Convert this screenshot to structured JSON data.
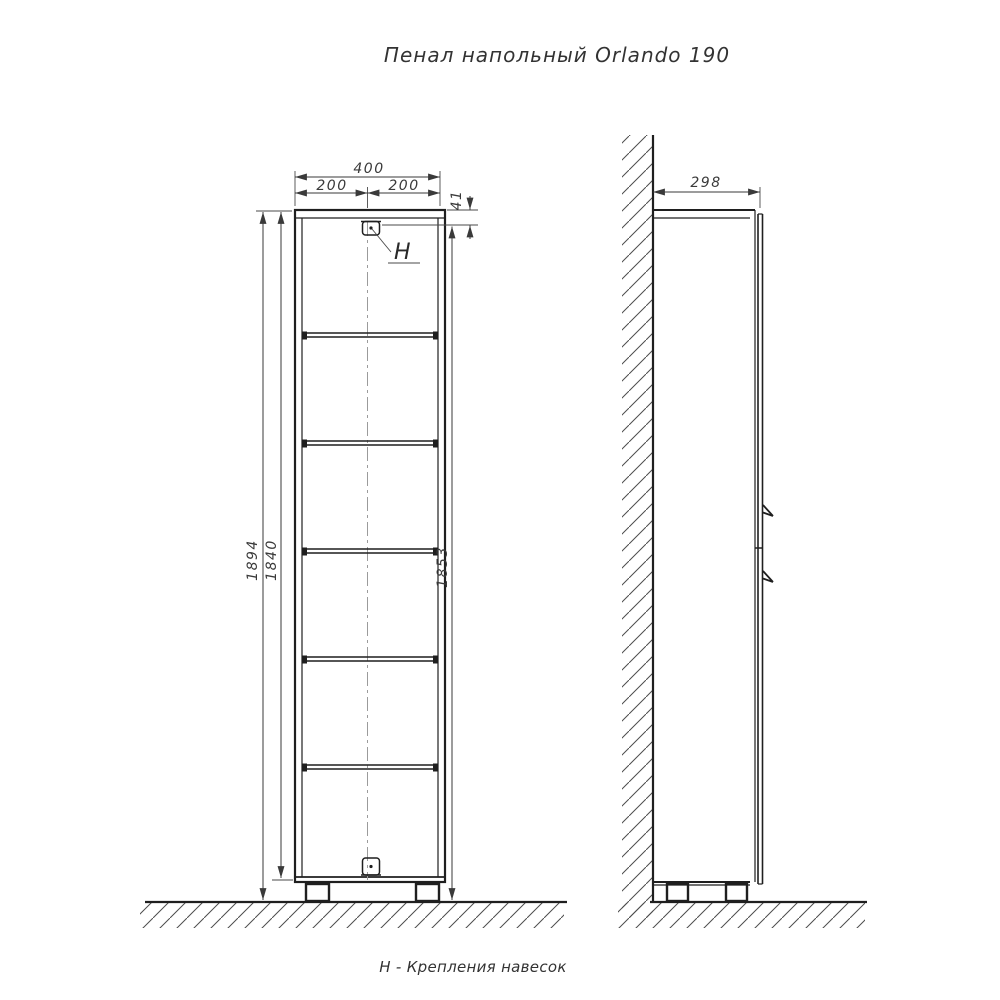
{
  "title": "Пенал напольный Orlando 190",
  "footnote": "Н - Крепления навесок",
  "hanger_marker": "Н",
  "front_view": {
    "dims": {
      "total_width": "400",
      "left_half_width": "200",
      "right_half_width": "200",
      "hanger_top_offset": "41",
      "overall_height": "1894",
      "carcass_height": "1840",
      "hanger_height_from_floor": "1853"
    },
    "shelf_count": 5
  },
  "side_view": {
    "dims": {
      "depth": "298"
    }
  },
  "colors": {
    "background": "#ffffff",
    "outline": "#1f1f1f",
    "dimension": "#3a3a3a",
    "centerline": "#9b9b9b",
    "hatch": "#4d4d4d"
  }
}
